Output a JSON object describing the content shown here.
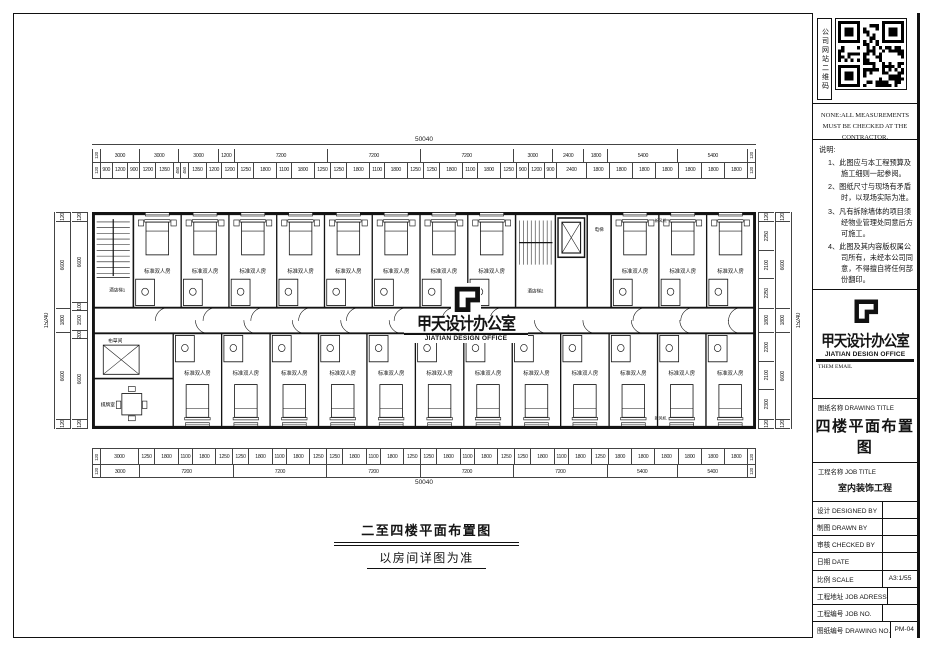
{
  "right_panel": {
    "qr_label": "公司网站二维码",
    "english_note": "NONE:ALL MEASUREMENTS MUST BE CHECKED AT THE CONTRACTOR.",
    "notes_title": "说明:",
    "notes": [
      "1、此图应与本工程预算及施工细则一起参阅。",
      "2、图纸尺寸与现场有矛盾时，以现场实际为准。",
      "3、凡有拆除墙体的项目须经物业管理处同意后方可施工。",
      "4、此图及其内容版权属公司所有，未经本公司同意，不得擅自将任何部份翻印。"
    ],
    "logo_cn": "甲天设计办公室",
    "logo_en": "JIATIAN DESIGN OFFICE",
    "logo_sub": "THEM EMAIL",
    "drawing_title_label": "图纸名称 DRAWING TITLE",
    "drawing_title": "四楼平面布置图",
    "job_title_label": "工程名称 JOB TITLE",
    "job_title": "室内装饰工程",
    "rows": [
      {
        "label": "设计  DESIGNED BY",
        "value": ""
      },
      {
        "label": "制图  DRAWN BY",
        "value": ""
      },
      {
        "label": "审核  CHECKED BY",
        "value": ""
      },
      {
        "label": "日期  DATE",
        "value": ""
      },
      {
        "label": "比例  SCALE",
        "value": "A3:1/55"
      },
      {
        "label": "工程地址 JOB ADRESS",
        "value": ""
      },
      {
        "label": "工程编号 JOB NO.",
        "value": ""
      },
      {
        "label": "图纸编号 DRAWING NO.",
        "value": "PM-04"
      }
    ]
  },
  "dims": {
    "top_overall": "50040",
    "top_spans": [
      120,
      3000,
      3000,
      3000,
      1200,
      7200,
      7200,
      7200,
      3000,
      2400,
      1800,
      5400,
      5400,
      120
    ],
    "top_sub": [
      120,
      900,
      1200,
      900,
      1200,
      1350,
      450,
      450,
      1350,
      1200,
      1200,
      1250,
      1800,
      1100,
      1800,
      1250,
      1250,
      1800,
      1100,
      1800,
      1250,
      1250,
      1800,
      1100,
      1800,
      1250,
      900,
      1200,
      900,
      2400,
      1800,
      1800,
      1800,
      1800,
      1800,
      1800,
      1800,
      120
    ],
    "bottom_sub": [
      120,
      3000,
      1250,
      1800,
      1100,
      1800,
      1250,
      1250,
      1800,
      1100,
      1800,
      1250,
      1250,
      1800,
      1100,
      1800,
      1250,
      1250,
      1800,
      1100,
      1800,
      1250,
      1250,
      1800,
      1100,
      1800,
      1250,
      1800,
      1800,
      1800,
      1800,
      1800,
      1800,
      120
    ],
    "bottom_spans": [
      120,
      3000,
      7200,
      7200,
      7200,
      7200,
      7200,
      5400,
      5400,
      120
    ],
    "bottom_overall": "50040",
    "left_overall": "15240",
    "left_mid": [
      120,
      6600,
      1800,
      6600,
      120
    ],
    "left_sub": [
      120,
      6600,
      100,
      1500,
      200,
      6600,
      120
    ],
    "right_sub": [
      120,
      2250,
      2100,
      2250,
      1800,
      2200,
      2100,
      2300,
      120
    ],
    "right_mid": [
      120,
      6600,
      1800,
      6600,
      120
    ],
    "right_overall": "15240"
  },
  "plan": {
    "room_label": "标准双人房",
    "stair1_label": "酒店梯1",
    "stair2_label": "酒店梯2",
    "elevator_label": "电梯",
    "linen_label": "布草间",
    "game_label": "棋牌室",
    "vent_top_label": "新风机",
    "vent_bottom_label": "新风机",
    "watermark_cn": "甲天设计办公室",
    "watermark_en": "JIATIAN DESIGN OFFICE"
  },
  "caption": {
    "line1": "二至四楼平面布置图",
    "line2": "以房间详图为准"
  }
}
